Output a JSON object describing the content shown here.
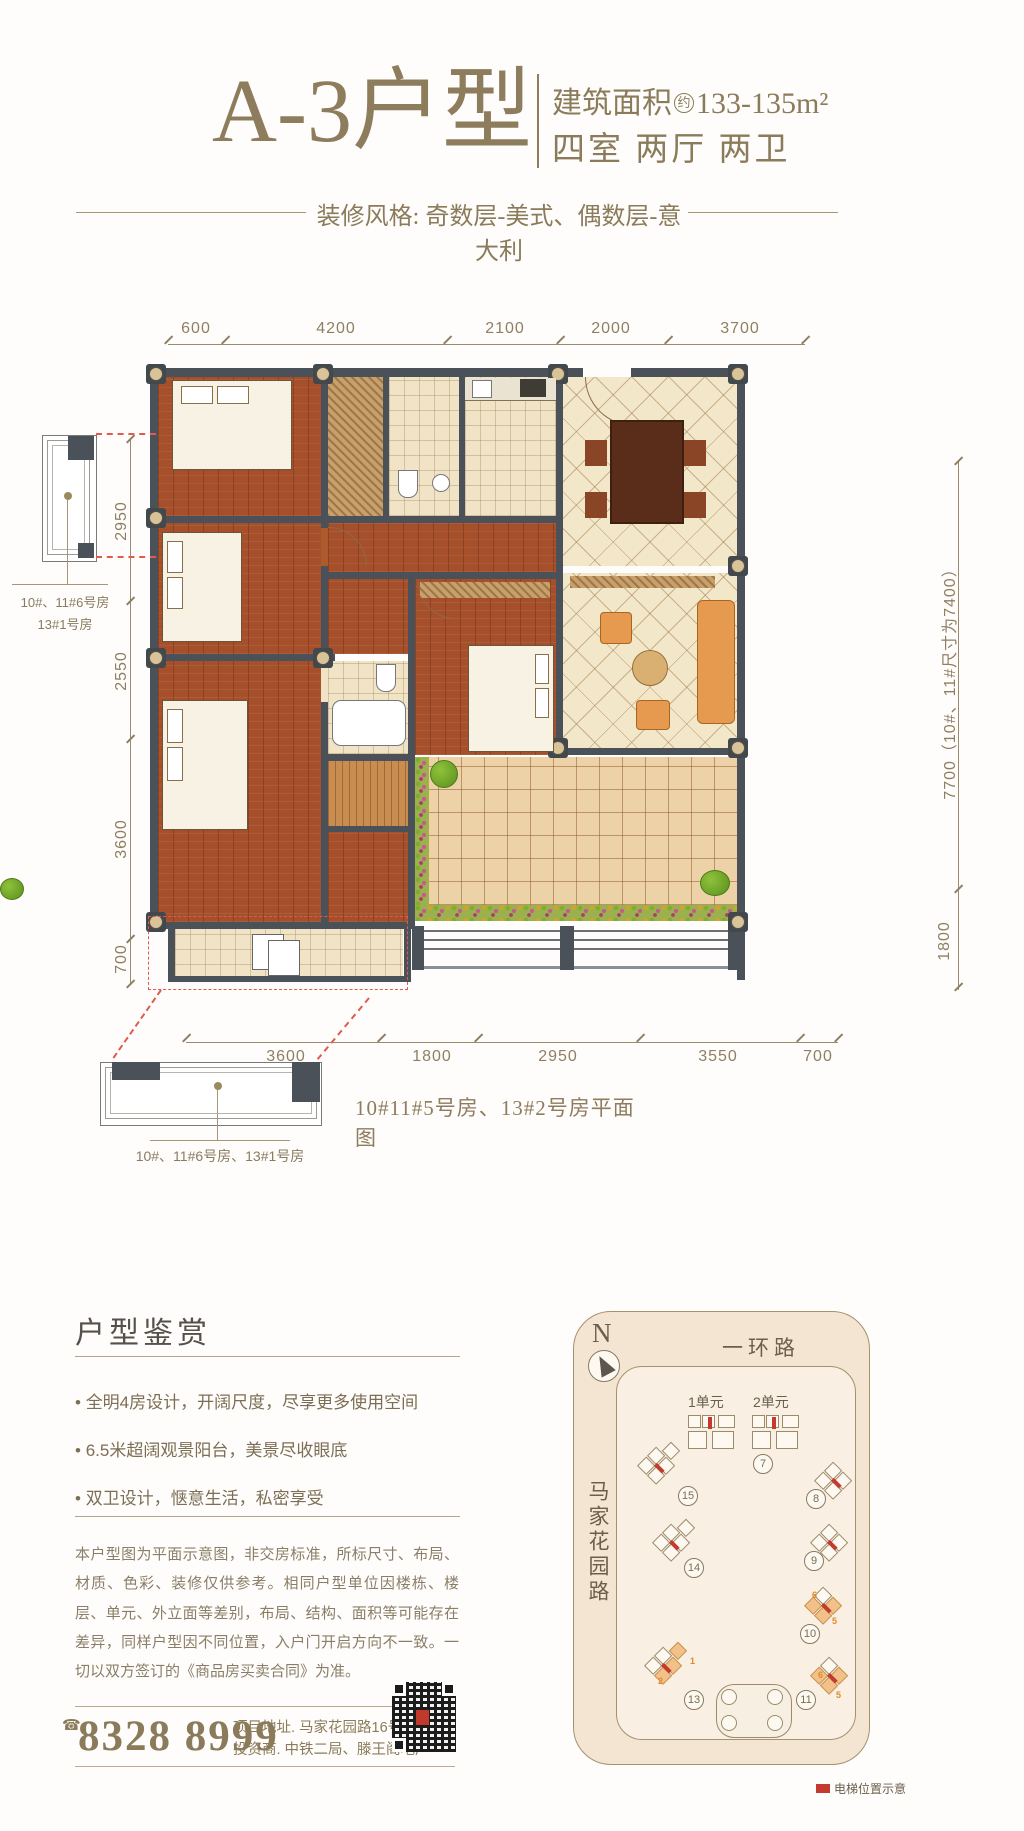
{
  "colors": {
    "accent_gold": "#8b7b5a",
    "wall_dark": "#4a5158",
    "elevator_red": "#c23b2e",
    "callout_red": "#e05a4e",
    "map_bg": "#f9efe2"
  },
  "header": {
    "title": "A-3户型",
    "area_prefix": "建筑面积",
    "area_circle": "约",
    "area_value": "133-135m²",
    "rooms_label": "四室 两厅 两卫",
    "style_note": "装修风格: 奇数层-美式、偶数层-意大利"
  },
  "plan": {
    "caption": "10#11#5号房、13#2号房平面图",
    "detail_top_label_line1": "10#、11#6号房",
    "detail_top_label_line2": "13#1号房",
    "detail_bottom_label": "10#、11#6号房、13#1号房",
    "dims_top": [
      "600",
      "4200",
      "2100",
      "2000",
      "3700"
    ],
    "dims_left": [
      "2950",
      "2550",
      "3600",
      "700"
    ],
    "dims_right": [
      "7700（10#、11#尺寸为7400）",
      "1800"
    ],
    "dims_bottom": [
      "3600",
      "1800",
      "2950",
      "3550",
      "700"
    ]
  },
  "appreciation": {
    "heading": "户型鉴赏",
    "bullets": [
      "全明4房设计，开阔尺度，尽享更多使用空间",
      "6.5米超阔观景阳台，美景尽收眼底",
      "双卫设计，惬意生活，私密享受"
    ]
  },
  "disclaimer": "本户型图为平面示意图，非交房标准，所标尺寸、布局、材质、色彩、装修仅供参考。相同户型单位因楼栋、楼层、单元、外立面等差别，布局、结构、面积等可能存在差异，同样户型因不同位置，入户门开启方向不一致。一切以双方签订的《商品房买卖合同》为准。",
  "contact": {
    "phone_icon": "☎",
    "phone": "8328 8999",
    "address": "项目地址. 马家花园路16号",
    "investor": "投资商. 中铁二局、滕王阁地产"
  },
  "sitemap": {
    "north": "N",
    "road_top": "一环路",
    "road_left": "马家花园路",
    "unit_labels": [
      "1单元",
      "2单元"
    ],
    "building_numbers": [
      "7",
      "15",
      "8",
      "14",
      "9",
      "10",
      "13",
      "11"
    ],
    "highlight_digits": {
      "b10": [
        "6",
        "5"
      ],
      "b13": [
        "1",
        "2"
      ],
      "b11": [
        "6",
        "5"
      ]
    },
    "legend": "电梯位置示意"
  }
}
